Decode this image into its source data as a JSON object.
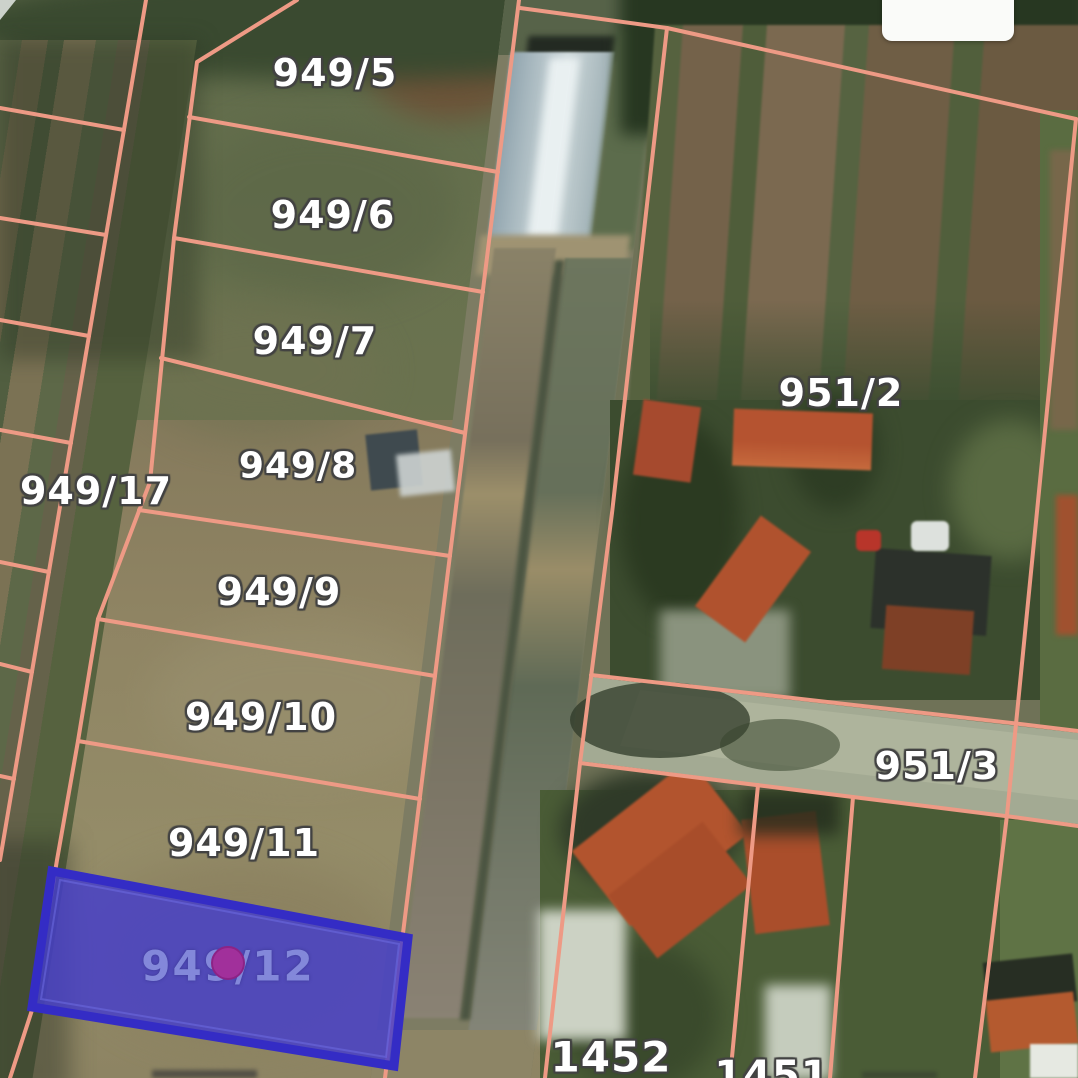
{
  "map": {
    "type": "cadastral-parcel-overlay-on-satellite",
    "boundary_line_color": "#ee9a85",
    "label_text_color": "#ffffff",
    "label_halo_color": "#424242",
    "parcel_labels": [
      {
        "label": "949/5"
      },
      {
        "label": "949/6"
      },
      {
        "label": "949/7"
      },
      {
        "label": "949/8"
      },
      {
        "label": "949/9"
      },
      {
        "label": "949/10"
      },
      {
        "label": "949/11"
      },
      {
        "label": "949/17"
      },
      {
        "label": "951/2"
      },
      {
        "label": "951/3"
      },
      {
        "label": "1452"
      },
      {
        "label": "1451"
      }
    ],
    "highlighted_parcel": {
      "label": "949/12",
      "fill_color": "#4a43c9",
      "border_color": "#342cc5",
      "label_color": "#8388da",
      "marker_color": "#a1309b"
    }
  },
  "ui": {
    "top_right_panel_text": ""
  }
}
